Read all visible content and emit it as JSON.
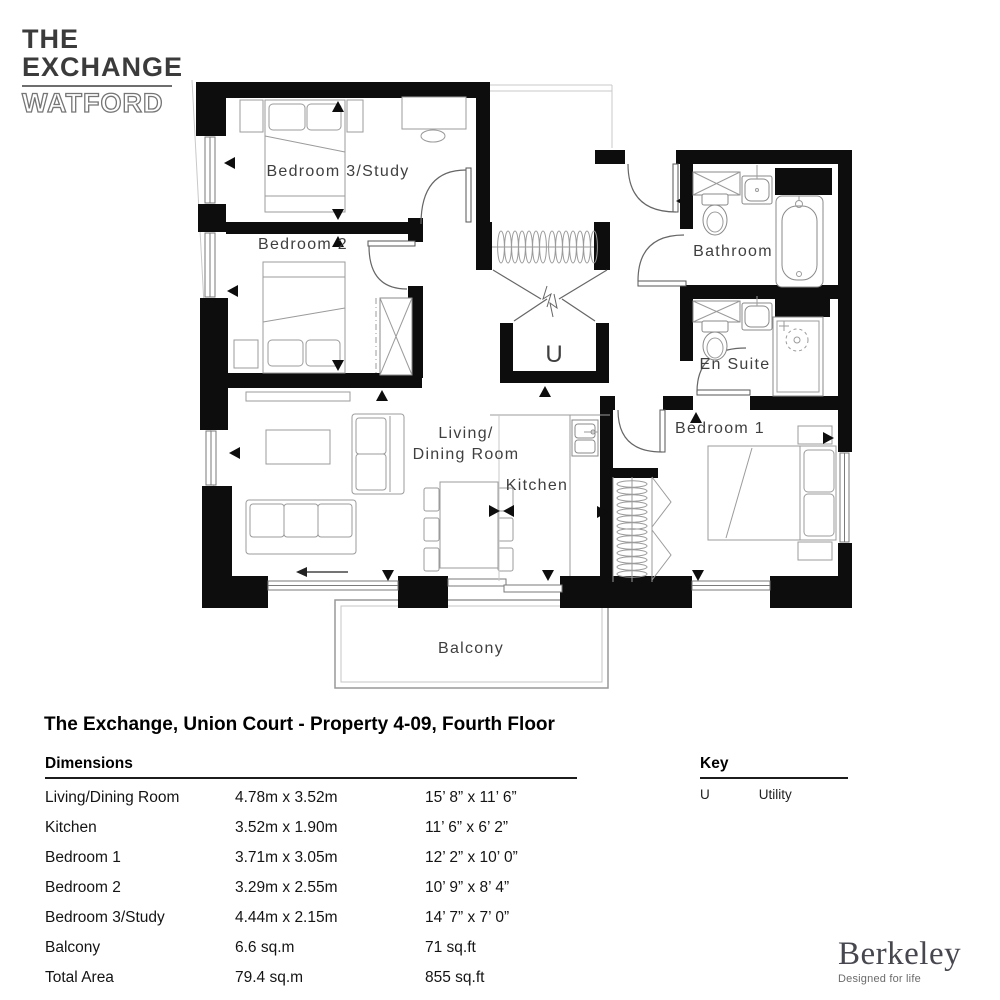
{
  "logo": {
    "line1": "THE",
    "line2": "EXCHANGE",
    "line3": "WATFORD"
  },
  "plan_labels": {
    "bedroom3": "Bedroom 3/Study",
    "bedroom2": "Bedroom 2",
    "bathroom": "Bathroom",
    "ensuite": "En Suite",
    "bedroom1": "Bedroom 1",
    "living_line1": "Living/",
    "living_line2": "Dining Room",
    "kitchen": "Kitchen",
    "utility_symbol": "U",
    "balcony": "Balcony"
  },
  "title": "The Exchange, Union Court - Property 4-09, Fourth Floor",
  "dimensions": {
    "heading": "Dimensions",
    "rows": [
      {
        "name": "Living/Dining Room",
        "metric": "4.78m x 3.52m",
        "imperial": "15’ 8” x 11’ 6”"
      },
      {
        "name": "Kitchen",
        "metric": "3.52m x 1.90m",
        "imperial": "11’ 6” x 6’ 2”"
      },
      {
        "name": "Bedroom 1",
        "metric": "3.71m x 3.05m",
        "imperial": "12’ 2” x 10’ 0”"
      },
      {
        "name": "Bedroom 2",
        "metric": "3.29m x 2.55m",
        "imperial": "10’ 9” x 8’ 4”"
      },
      {
        "name": "Bedroom 3/Study",
        "metric": "4.44m x 2.15m",
        "imperial": "14’ 7” x 7’ 0”"
      },
      {
        "name": "Balcony",
        "metric": "6.6 sq.m",
        "imperial": "71 sq.ft"
      },
      {
        "name": "Total Area",
        "metric": "79.4 sq.m",
        "imperial": "855 sq.ft"
      }
    ]
  },
  "key": {
    "heading": "Key",
    "entries": [
      {
        "symbol": "U",
        "label": "Utility"
      }
    ]
  },
  "brand": {
    "name": "Berkeley",
    "tagline": "Designed for life"
  },
  "colors": {
    "wall": "#0d0d0d",
    "furniture": "#9b9b9b",
    "label": "#3f3f3f"
  }
}
